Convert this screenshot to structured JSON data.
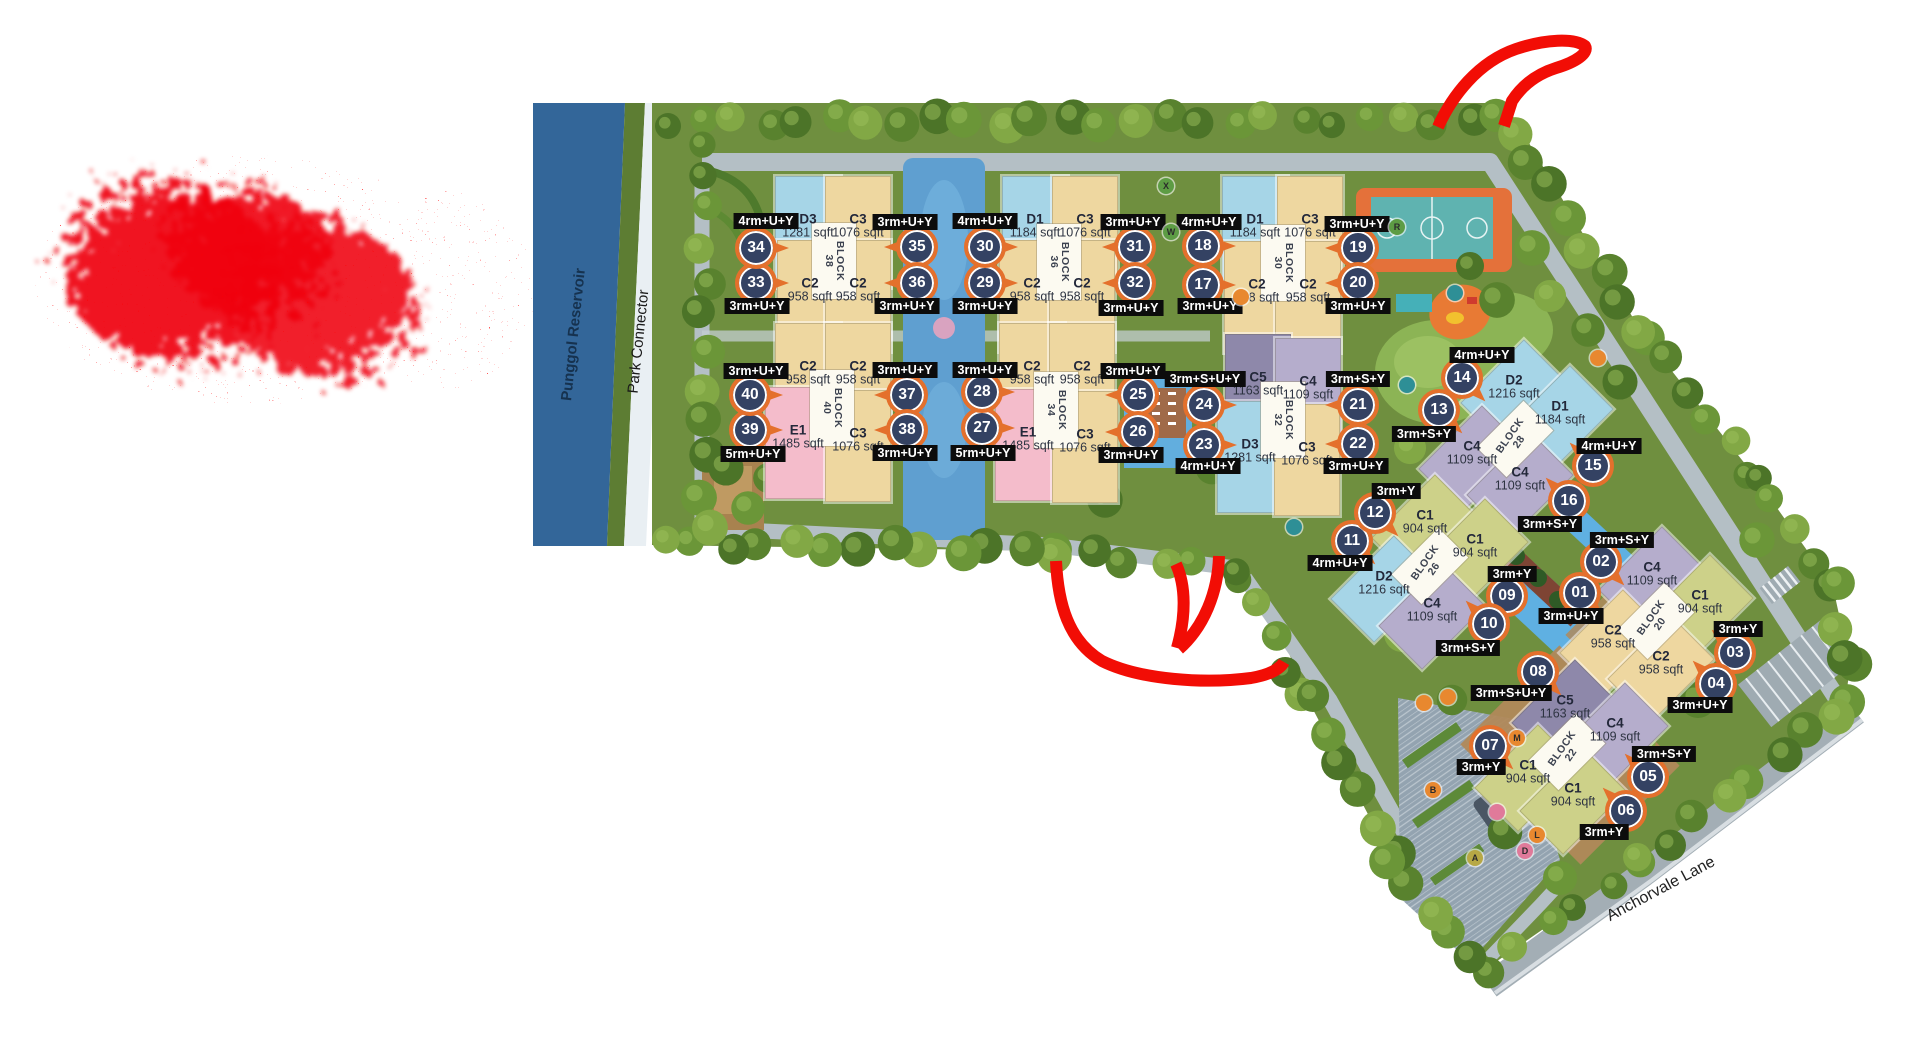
{
  "labels": {
    "reservoir": "Punggol Reservoir",
    "park_connector": "Park Connector",
    "street": "Anchorvale Lane"
  },
  "palette": {
    "annotation_red": "#f20d05",
    "marker_ring": "#e4702c",
    "marker_fill": "#344263",
    "chip_bg": "#0c0c0c",
    "water": "#336699",
    "site_green": "#6f8f3f",
    "units": {
      "C1": "#cdd189",
      "C2": "#eed7a0",
      "C3": "#eed7a0",
      "C4": "#b5adcc",
      "C5": "#8e88aa",
      "D1": "#a6d5e7",
      "D2": "#a6d5e7",
      "D3": "#a6d5e7",
      "E1": "#f4bccb"
    }
  },
  "blocks": [
    {
      "block": "BLOCK",
      "number": "38",
      "x": 834,
      "y": 261,
      "diagonal": false,
      "units": [
        {
          "code": "D3",
          "size": "1281 sqft",
          "x": 808,
          "y": 226
        },
        {
          "code": "C3",
          "size": "1076 sqft",
          "x": 858,
          "y": 226
        },
        {
          "code": "C2",
          "size": "958 sqft",
          "x": 810,
          "y": 290
        },
        {
          "code": "C2",
          "size": "958 sqft",
          "x": 858,
          "y": 290
        }
      ]
    },
    {
      "block": "BLOCK",
      "number": "36",
      "x": 1059,
      "y": 262,
      "diagonal": false,
      "units": [
        {
          "code": "D1",
          "size": "1184 sqft",
          "x": 1035,
          "y": 226
        },
        {
          "code": "C3",
          "size": "1076 sqft",
          "x": 1085,
          "y": 226
        },
        {
          "code": "C2",
          "size": "958 sqft",
          "x": 1032,
          "y": 290
        },
        {
          "code": "C2",
          "size": "958 sqft",
          "x": 1082,
          "y": 290
        }
      ]
    },
    {
      "block": "BLOCK",
      "number": "30",
      "x": 1283,
      "y": 263,
      "diagonal": false,
      "units": [
        {
          "code": "D1",
          "size": "1184 sqft",
          "x": 1255,
          "y": 226
        },
        {
          "code": "C3",
          "size": "1076 sqft",
          "x": 1310,
          "y": 226
        },
        {
          "code": "C2",
          "size": "958 sqft",
          "x": 1257,
          "y": 291
        },
        {
          "code": "C2",
          "size": "958 sqft",
          "x": 1308,
          "y": 291
        }
      ]
    },
    {
      "block": "BLOCK",
      "number": "40",
      "x": 832,
      "y": 408,
      "diagonal": false,
      "units": [
        {
          "code": "C2",
          "size": "958 sqft",
          "x": 808,
          "y": 373
        },
        {
          "code": "C2",
          "size": "958 sqft",
          "x": 858,
          "y": 373
        },
        {
          "code": "E1",
          "size": "1485 sqft",
          "x": 798,
          "y": 437
        },
        {
          "code": "C3",
          "size": "1076 sqft",
          "x": 858,
          "y": 440
        }
      ]
    },
    {
      "block": "BLOCK",
      "number": "34",
      "x": 1056,
      "y": 410,
      "diagonal": false,
      "units": [
        {
          "code": "C2",
          "size": "958 sqft",
          "x": 1032,
          "y": 373
        },
        {
          "code": "C2",
          "size": "958 sqft",
          "x": 1082,
          "y": 373
        },
        {
          "code": "E1",
          "size": "1485 sqft",
          "x": 1028,
          "y": 439
        },
        {
          "code": "C3",
          "size": "1076 sqft",
          "x": 1085,
          "y": 441
        }
      ]
    },
    {
      "block": "BLOCK",
      "number": "32",
      "x": 1283,
      "y": 420,
      "diagonal": false,
      "units": [
        {
          "code": "C5",
          "size": "1163 sqft",
          "x": 1258,
          "y": 384
        },
        {
          "code": "C4",
          "size": "1109 sqft",
          "x": 1308,
          "y": 388
        },
        {
          "code": "D3",
          "size": "1281 sqft",
          "x": 1250,
          "y": 451
        },
        {
          "code": "C3",
          "size": "1076 sqft",
          "x": 1307,
          "y": 454
        }
      ]
    },
    {
      "block": "BLOCK",
      "number": "28",
      "x": 1515,
      "y": 439,
      "diagonal": true,
      "units": [
        {
          "code": "D2",
          "size": "1216 sqft",
          "x": 1514,
          "y": 387
        },
        {
          "code": "D1",
          "size": "1184 sqft",
          "x": 1560,
          "y": 413
        },
        {
          "code": "C4",
          "size": "1109 sqft",
          "x": 1472,
          "y": 453
        },
        {
          "code": "C4",
          "size": "1109 sqft",
          "x": 1520,
          "y": 479
        }
      ]
    },
    {
      "block": "BLOCK",
      "number": "26",
      "x": 1430,
      "y": 566,
      "diagonal": true,
      "units": [
        {
          "code": "C1",
          "size": "904 sqft",
          "x": 1425,
          "y": 522
        },
        {
          "code": "C1",
          "size": "904 sqft",
          "x": 1475,
          "y": 546
        },
        {
          "code": "D2",
          "size": "1216 sqft",
          "x": 1384,
          "y": 583
        },
        {
          "code": "C4",
          "size": "1109 sqft",
          "x": 1432,
          "y": 610
        }
      ]
    },
    {
      "block": "BLOCK",
      "number": "20",
      "x": 1656,
      "y": 621,
      "diagonal": true,
      "units": [
        {
          "code": "C4",
          "size": "1109 sqft",
          "x": 1652,
          "y": 574
        },
        {
          "code": "C1",
          "size": "904 sqft",
          "x": 1700,
          "y": 602
        },
        {
          "code": "C2",
          "size": "958 sqft",
          "x": 1613,
          "y": 637
        },
        {
          "code": "C2",
          "size": "958 sqft",
          "x": 1661,
          "y": 663
        }
      ]
    },
    {
      "block": "BLOCK",
      "number": "22",
      "x": 1567,
      "y": 752,
      "diagonal": true,
      "units": [
        {
          "code": "C5",
          "size": "1163 sqft",
          "x": 1565,
          "y": 707
        },
        {
          "code": "C4",
          "size": "1109 sqft",
          "x": 1615,
          "y": 730
        },
        {
          "code": "C1",
          "size": "904 sqft",
          "x": 1528,
          "y": 772
        },
        {
          "code": "C1",
          "size": "904 sqft",
          "x": 1573,
          "y": 795
        }
      ]
    }
  ],
  "stacks": [
    {
      "no": "01",
      "x": 1580,
      "y": 593,
      "dir": "dr",
      "type": "3rm+U+Y",
      "cx": 1571,
      "cy": 616
    },
    {
      "no": "02",
      "x": 1601,
      "y": 562,
      "dir": "dr",
      "type": "3rm+S+Y",
      "cx": 1622,
      "cy": 540
    },
    {
      "no": "03",
      "x": 1735,
      "y": 653,
      "dir": "ul",
      "type": "3rm+Y",
      "cx": 1738,
      "cy": 629
    },
    {
      "no": "04",
      "x": 1716,
      "y": 684,
      "dir": "ul",
      "type": "3rm+U+Y",
      "cx": 1700,
      "cy": 705
    },
    {
      "no": "05",
      "x": 1648,
      "y": 777,
      "dir": "ul",
      "type": "3rm+S+Y",
      "cx": 1664,
      "cy": 754
    },
    {
      "no": "06",
      "x": 1626,
      "y": 811,
      "dir": "ul",
      "type": "3rm+Y",
      "cx": 1604,
      "cy": 832
    },
    {
      "no": "07",
      "x": 1490,
      "y": 746,
      "dir": "dr",
      "type": "3rm+Y",
      "cx": 1481,
      "cy": 767
    },
    {
      "no": "08",
      "x": 1538,
      "y": 672,
      "dir": "dr",
      "type": "3rm+S+U+Y",
      "cx": 1511,
      "cy": 693
    },
    {
      "no": "09",
      "x": 1507,
      "y": 596,
      "dir": "dl",
      "type": "3rm+Y",
      "cx": 1512,
      "cy": 574
    },
    {
      "no": "10",
      "x": 1489,
      "y": 624,
      "dir": "ul",
      "type": "3rm+S+Y",
      "cx": 1468,
      "cy": 648
    },
    {
      "no": "11",
      "x": 1352,
      "y": 541,
      "dir": "dr",
      "type": "4rm+U+Y",
      "cx": 1340,
      "cy": 563
    },
    {
      "no": "12",
      "x": 1375,
      "y": 513,
      "dir": "dr",
      "type": "3rm+Y",
      "cx": 1396,
      "cy": 491
    },
    {
      "no": "13",
      "x": 1439,
      "y": 410,
      "dir": "dr",
      "type": "3rm+S+Y",
      "cx": 1424,
      "cy": 434
    },
    {
      "no": "14",
      "x": 1462,
      "y": 378,
      "dir": "dr",
      "type": "4rm+U+Y",
      "cx": 1482,
      "cy": 355
    },
    {
      "no": "15",
      "x": 1593,
      "y": 466,
      "dir": "ul",
      "type": "4rm+U+Y",
      "cx": 1609,
      "cy": 446
    },
    {
      "no": "16",
      "x": 1569,
      "y": 501,
      "dir": "ul",
      "type": "3rm+S+Y",
      "cx": 1550,
      "cy": 524
    },
    {
      "no": "17",
      "x": 1203,
      "y": 285,
      "dir": "r",
      "type": "3rm+U+Y",
      "cx": 1210,
      "cy": 306
    },
    {
      "no": "18",
      "x": 1203,
      "y": 246,
      "dir": "r",
      "type": "4rm+U+Y",
      "cx": 1209,
      "cy": 222
    },
    {
      "no": "19",
      "x": 1358,
      "y": 248,
      "dir": "l",
      "type": "3rm+U+Y",
      "cx": 1357,
      "cy": 224
    },
    {
      "no": "20",
      "x": 1358,
      "y": 283,
      "dir": "l",
      "type": "3rm+U+Y",
      "cx": 1358,
      "cy": 306
    },
    {
      "no": "21",
      "x": 1358,
      "y": 405,
      "dir": "l",
      "type": "3rm+S+Y",
      "cx": 1358,
      "cy": 379
    },
    {
      "no": "22",
      "x": 1358,
      "y": 444,
      "dir": "l",
      "type": "3rm+U+Y",
      "cx": 1356,
      "cy": 466
    },
    {
      "no": "23",
      "x": 1204,
      "y": 445,
      "dir": "r",
      "type": "4rm+U+Y",
      "cx": 1208,
      "cy": 466
    },
    {
      "no": "24",
      "x": 1204,
      "y": 405,
      "dir": "r",
      "type": "3rm+S+U+Y",
      "cx": 1205,
      "cy": 379
    },
    {
      "no": "25",
      "x": 1138,
      "y": 395,
      "dir": "l",
      "type": "3rm+U+Y",
      "cx": 1133,
      "cy": 371
    },
    {
      "no": "26",
      "x": 1138,
      "y": 432,
      "dir": "l",
      "type": "3rm+U+Y",
      "cx": 1131,
      "cy": 455
    },
    {
      "no": "27",
      "x": 982,
      "y": 428,
      "dir": "r",
      "type": "5rm+U+Y",
      "cx": 983,
      "cy": 453
    },
    {
      "no": "28",
      "x": 982,
      "y": 392,
      "dir": "r",
      "type": "3rm+U+Y",
      "cx": 985,
      "cy": 370
    },
    {
      "no": "29",
      "x": 985,
      "y": 283,
      "dir": "r",
      "type": "3rm+U+Y",
      "cx": 985,
      "cy": 306
    },
    {
      "no": "30",
      "x": 985,
      "y": 247,
      "dir": "r",
      "type": "4rm+U+Y",
      "cx": 985,
      "cy": 221
    },
    {
      "no": "31",
      "x": 1135,
      "y": 247,
      "dir": "l",
      "type": "3rm+U+Y",
      "cx": 1133,
      "cy": 222
    },
    {
      "no": "32",
      "x": 1135,
      "y": 283,
      "dir": "l",
      "type": "3rm+U+Y",
      "cx": 1131,
      "cy": 308
    },
    {
      "no": "33",
      "x": 756,
      "y": 283,
      "dir": "r",
      "type": "3rm+U+Y",
      "cx": 757,
      "cy": 306
    },
    {
      "no": "34",
      "x": 756,
      "y": 248,
      "dir": "r",
      "type": "4rm+U+Y",
      "cx": 766,
      "cy": 221
    },
    {
      "no": "35",
      "x": 917,
      "y": 247,
      "dir": "l",
      "type": "3rm+U+Y",
      "cx": 905,
      "cy": 222
    },
    {
      "no": "36",
      "x": 917,
      "y": 283,
      "dir": "l",
      "type": "3rm+U+Y",
      "cx": 907,
      "cy": 306
    },
    {
      "no": "37",
      "x": 907,
      "y": 395,
      "dir": "l",
      "type": "3rm+U+Y",
      "cx": 905,
      "cy": 370
    },
    {
      "no": "38",
      "x": 907,
      "y": 430,
      "dir": "l",
      "type": "3rm+U+Y",
      "cx": 905,
      "cy": 453
    },
    {
      "no": "39",
      "x": 750,
      "y": 430,
      "dir": "r",
      "type": "5rm+U+Y",
      "cx": 753,
      "cy": 454
    },
    {
      "no": "40",
      "x": 750,
      "y": 395,
      "dir": "r",
      "type": "3rm+U+Y",
      "cx": 756,
      "cy": 371
    }
  ],
  "amenity_badges": [
    {
      "t": "X",
      "x": 1166,
      "y": 186,
      "c": "#5d9c44"
    },
    {
      "t": "W",
      "x": 1171,
      "y": 232,
      "c": "#5d9c44"
    },
    {
      "t": "R",
      "x": 1397,
      "y": 227,
      "c": "#5d9c44"
    },
    {
      "t": "M",
      "x": 1517,
      "y": 738,
      "c": "#e8882f"
    },
    {
      "t": "B",
      "x": 1433,
      "y": 790,
      "c": "#e8882f"
    },
    {
      "t": "L",
      "x": 1537,
      "y": 835,
      "c": "#e8882f"
    },
    {
      "t": "D",
      "x": 1525,
      "y": 851,
      "c": "#e07a9a"
    },
    {
      "t": "A",
      "x": 1475,
      "y": 858,
      "c": "#b7a845"
    },
    {
      "t": "",
      "x": 1497,
      "y": 812,
      "c": "#e07a9a"
    },
    {
      "t": "",
      "x": 1598,
      "y": 358,
      "c": "#e8882f"
    },
    {
      "t": "",
      "x": 1455,
      "y": 293,
      "c": "#2e8f96"
    },
    {
      "t": "",
      "x": 1407,
      "y": 385,
      "c": "#2e8f96"
    },
    {
      "t": "",
      "x": 1294,
      "y": 527,
      "c": "#2e8f96"
    },
    {
      "t": "",
      "x": 1448,
      "y": 697,
      "c": "#e8882f"
    },
    {
      "t": "",
      "x": 1424,
      "y": 703,
      "c": "#e8882f"
    },
    {
      "t": "",
      "x": 1241,
      "y": 297,
      "c": "#e8882f"
    }
  ]
}
